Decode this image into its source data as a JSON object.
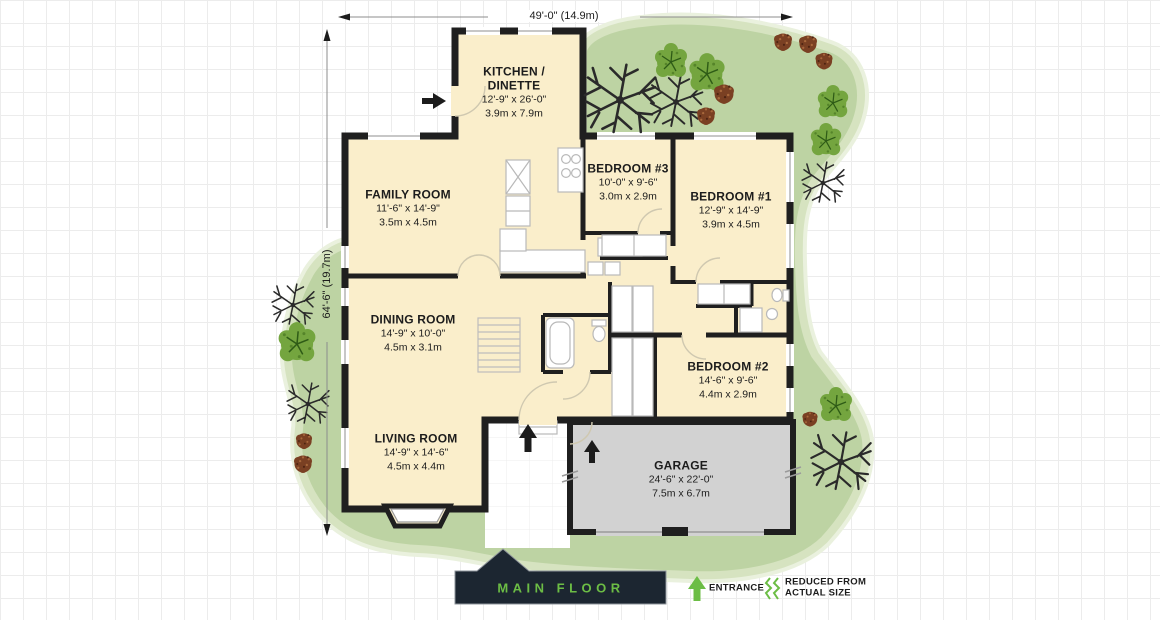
{
  "plan": {
    "sheet_title": "MAIN FLOOR",
    "dimensions": {
      "width_label": "49'-0\" (14.9m)",
      "height_label": "64'-6\" (19.7m)"
    },
    "rooms": [
      {
        "id": "kitchen",
        "name": "KITCHEN / DINETTE",
        "imperial": "12'-9\" x 26'-0\"",
        "metric": "3.9m x 7.9m"
      },
      {
        "id": "family",
        "name": "FAMILY ROOM",
        "imperial": "11'-6\" x 14'-9\"",
        "metric": "3.5m x 4.5m"
      },
      {
        "id": "bedroom3",
        "name": "BEDROOM #3",
        "imperial": "10'-0\" x 9'-6\"",
        "metric": "3.0m x 2.9m"
      },
      {
        "id": "bedroom1",
        "name": "BEDROOM #1",
        "imperial": "12'-9\" x 14'-9\"",
        "metric": "3.9m x 4.5m"
      },
      {
        "id": "dining",
        "name": "DINING ROOM",
        "imperial": "14'-9\" x 10'-0\"",
        "metric": "4.5m x 3.1m"
      },
      {
        "id": "bedroom2",
        "name": "BEDROOM #2",
        "imperial": "14'-6\" x 9'-6\"",
        "metric": "4.4m x 2.9m"
      },
      {
        "id": "living",
        "name": "LIVING ROOM",
        "imperial": "14'-9\" x 14'-6\"",
        "metric": "4.5m x 4.4m"
      },
      {
        "id": "garage",
        "name": "GARAGE",
        "imperial": "24'-6\" x 22'-0\"",
        "metric": "7.5m x 6.7m"
      }
    ],
    "legend": {
      "entrance_label": "ENTRANCE",
      "reduced_line1": "REDUCED FROM",
      "reduced_line2": "ACTUAL SIZE"
    },
    "colors": {
      "accent_green": "#6cbd45",
      "lawn_green": "#bdd3a3",
      "room_fill": "#faeecb",
      "garage_fill": "#d2d2d2",
      "wall_black": "#1f1f1f",
      "banner_bg": "#1c2631"
    }
  }
}
